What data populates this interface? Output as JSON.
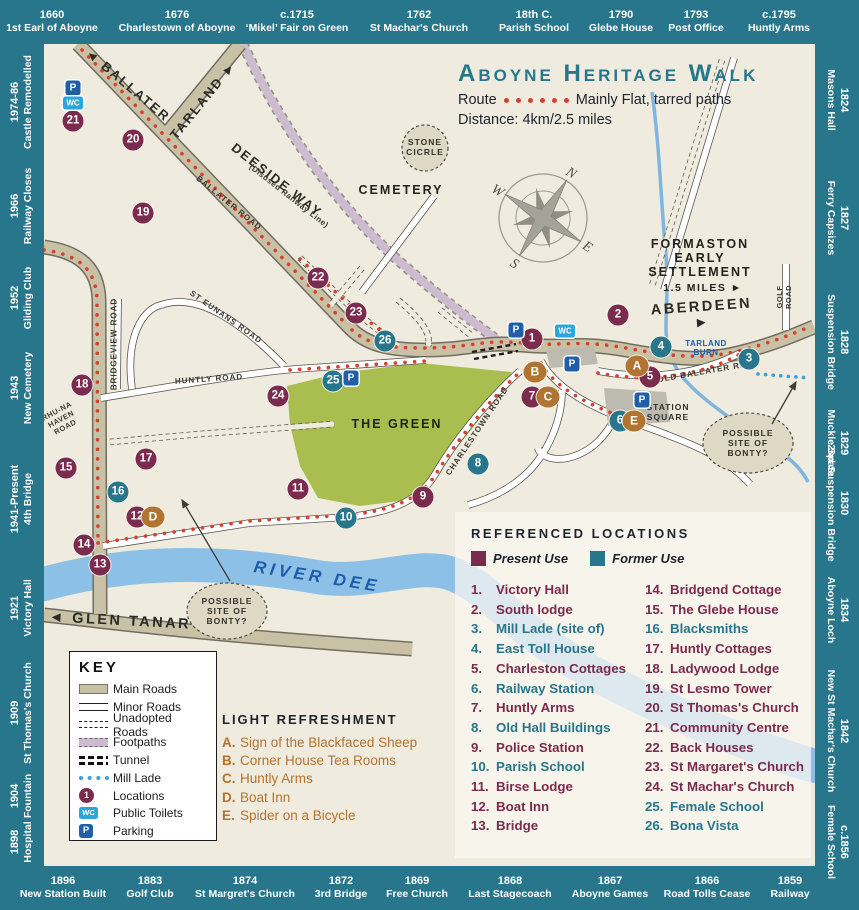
{
  "colors": {
    "border_teal": "#27768B",
    "map_cream": "#EFEBDF",
    "present_use": "#7B2B4E",
    "former_use": "#27768B",
    "refreshment_brown": "#B27431",
    "route_red": "#D6402E",
    "river_blue": "#8CC0E6",
    "parking_blue": "#1E5FA8",
    "wc_blue": "#2BA6DC",
    "green_area": "#A9BE4F",
    "main_road_tan": "#C9C1A6",
    "footpath_mauve": "#CDBBD0"
  },
  "header": {
    "title": "Aboyne Heritage Walk",
    "route_label": "Route",
    "route_desc": "Mainly Flat, tarred paths",
    "route_dots": 6,
    "distance": "Distance: 4km/2.5 miles"
  },
  "timeline": {
    "top": [
      {
        "year": "1660",
        "label": "1st Earl of Aboyne",
        "cx": 52
      },
      {
        "year": "1676",
        "label": "Charlestown of Aboyne",
        "cx": 177
      },
      {
        "year": "c.1715",
        "label": "‘Mikel’ Fair on Green",
        "cx": 297
      },
      {
        "year": "1762",
        "label": "St Machar's Church",
        "cx": 419
      },
      {
        "year": "18th C.",
        "label": "Parish School",
        "cx": 534
      },
      {
        "year": "1790",
        "label": "Glebe House",
        "cx": 621
      },
      {
        "year": "1793",
        "label": "Post Office",
        "cx": 696
      },
      {
        "year": "c.1795",
        "label": "Huntly Arms",
        "cx": 779
      }
    ],
    "bottom": [
      {
        "year": "1896",
        "label": "New Station Built",
        "cx": 63
      },
      {
        "year": "1883",
        "label": "Golf Club",
        "cx": 150
      },
      {
        "year": "1874",
        "label": "St Margret's Church",
        "cx": 245
      },
      {
        "year": "1872",
        "label": "3rd Bridge",
        "cx": 341
      },
      {
        "year": "1869",
        "label": "Free Church",
        "cx": 417
      },
      {
        "year": "1868",
        "label": "Last Stagecoach",
        "cx": 510
      },
      {
        "year": "1867",
        "label": "Aboyne Games",
        "cx": 610
      },
      {
        "year": "1866",
        "label": "Road Tolls Cease",
        "cx": 707
      },
      {
        "year": "1859",
        "label": "Railway",
        "cx": 790
      }
    ],
    "left": [
      {
        "year": "1974-86",
        "label": "Castle Remodelled",
        "cy": 102
      },
      {
        "year": "1966",
        "label": "Railway Closes",
        "cy": 206
      },
      {
        "year": "1952",
        "label": "Gliding Club",
        "cy": 298
      },
      {
        "year": "1943",
        "label": "New Cemetery",
        "cy": 388
      },
      {
        "year": "1941-Present",
        "label": "4th Bridge",
        "cy": 499
      },
      {
        "year": "1921",
        "label": "Victory Hall",
        "cy": 608
      },
      {
        "year": "1909",
        "label": "St Thomas's Church",
        "cy": 713
      },
      {
        "year": "1904",
        "label": "Fountain",
        "cy": 796
      },
      {
        "year": "1898",
        "label": "Hospital",
        "cy": 842
      }
    ],
    "right": [
      {
        "year": "1824",
        "label": "Masons Hall",
        "cy": 100
      },
      {
        "year": "1827",
        "label": "Ferry Capsizes",
        "cy": 218
      },
      {
        "year": "1828",
        "label": "Suspension Bridge",
        "cy": 342
      },
      {
        "year": "1829",
        "label": "Muckle Spate",
        "cy": 443
      },
      {
        "year": "1830",
        "label": "2nd Suspension Bridge",
        "cy": 503
      },
      {
        "year": "1834",
        "label": "Aboyne Loch",
        "cy": 610
      },
      {
        "year": "1842",
        "label": "New St Machar's Church",
        "cy": 731
      },
      {
        "year": "c.1856",
        "label": "Female School",
        "cy": 842
      }
    ]
  },
  "key": {
    "title": "KEY",
    "items": [
      {
        "label": "Main Roads",
        "swatch": "main"
      },
      {
        "label": "Minor Roads",
        "swatch": "minor"
      },
      {
        "label": "Unadopted Roads",
        "swatch": "unadopted"
      },
      {
        "label": "Footpaths",
        "swatch": "footpath"
      },
      {
        "label": "Tunnel",
        "swatch": "tunnel"
      },
      {
        "label": "Mill Lade",
        "swatch": "lade"
      },
      {
        "label": "Locations",
        "swatch": "locations",
        "icon_text": "1"
      },
      {
        "label": "Public Toilets",
        "swatch": "wc",
        "icon_text": "WC"
      },
      {
        "label": "Parking",
        "swatch": "parking",
        "icon_text": "P"
      }
    ]
  },
  "refreshment": {
    "title": "LIGHT REFRESHMENT",
    "items": [
      {
        "letter": "A.",
        "name": "Sign of the Blackfaced Sheep"
      },
      {
        "letter": "B.",
        "name": "Corner House Tea Rooms"
      },
      {
        "letter": "C.",
        "name": "Huntly Arms"
      },
      {
        "letter": "D.",
        "name": "Boat Inn"
      },
      {
        "letter": "E.",
        "name": "Spider on a Bicycle"
      }
    ]
  },
  "locations": {
    "title": "REFERENCED LOCATIONS",
    "legend": [
      {
        "label": "Present Use",
        "use": "present"
      },
      {
        "label": "Former Use",
        "use": "former"
      }
    ],
    "items": [
      {
        "num": "1.",
        "name": "Victory Hall",
        "use": "present"
      },
      {
        "num": "2.",
        "name": "South lodge",
        "use": "present"
      },
      {
        "num": "3.",
        "name": "Mill Lade (site of)",
        "use": "former"
      },
      {
        "num": "4.",
        "name": "East Toll House",
        "use": "former"
      },
      {
        "num": "5.",
        "name": "Charleston Cottages",
        "use": "present"
      },
      {
        "num": "6.",
        "name": "Railway Station",
        "use": "former"
      },
      {
        "num": "7.",
        "name": "Huntly Arms",
        "use": "present"
      },
      {
        "num": "8.",
        "name": "Old Hall Buildings",
        "use": "former"
      },
      {
        "num": "9.",
        "name": "Police Station",
        "use": "present"
      },
      {
        "num": "10.",
        "name": "Parish School",
        "use": "former"
      },
      {
        "num": "11.",
        "name": "Birse Lodge",
        "use": "present"
      },
      {
        "num": "12.",
        "name": "Boat Inn",
        "use": "present"
      },
      {
        "num": "13.",
        "name": "Bridge",
        "use": "present"
      },
      {
        "num": "14.",
        "name": "Bridgend Cottage",
        "use": "present"
      },
      {
        "num": "15.",
        "name": "The Glebe House",
        "use": "present"
      },
      {
        "num": "16.",
        "name": "Blacksmiths",
        "use": "former"
      },
      {
        "num": "17.",
        "name": "Huntly Cottages",
        "use": "present"
      },
      {
        "num": "18.",
        "name": "Ladywood Lodge",
        "use": "present"
      },
      {
        "num": "19.",
        "name": "St Lesmo Tower",
        "use": "present"
      },
      {
        "num": "20.",
        "name": "St Thomas's Church",
        "use": "present"
      },
      {
        "num": "21.",
        "name": "Community Centre",
        "use": "present"
      },
      {
        "num": "22.",
        "name": "Back Houses",
        "use": "present"
      },
      {
        "num": "23.",
        "name": "St Margaret's Church",
        "use": "present"
      },
      {
        "num": "24.",
        "name": "St Machar's Church",
        "use": "present"
      },
      {
        "num": "25.",
        "name": "Female School",
        "use": "former"
      },
      {
        "num": "26.",
        "name": "Bona Vista",
        "use": "former"
      }
    ]
  },
  "markers": {
    "parking_label": "P",
    "wc_label": "WC",
    "numbered": [
      {
        "n": "1",
        "x": 532,
        "y": 339,
        "use": "present"
      },
      {
        "n": "2",
        "x": 618,
        "y": 315,
        "use": "present"
      },
      {
        "n": "3",
        "x": 749,
        "y": 359,
        "use": "former"
      },
      {
        "n": "4",
        "x": 661,
        "y": 347,
        "use": "former"
      },
      {
        "n": "5",
        "x": 650,
        "y": 377,
        "use": "present"
      },
      {
        "n": "6",
        "x": 620,
        "y": 421,
        "use": "former"
      },
      {
        "n": "7",
        "x": 532,
        "y": 397,
        "use": "present"
      },
      {
        "n": "8",
        "x": 478,
        "y": 464,
        "use": "former"
      },
      {
        "n": "9",
        "x": 423,
        "y": 497,
        "use": "present"
      },
      {
        "n": "10",
        "x": 346,
        "y": 518,
        "use": "former"
      },
      {
        "n": "11",
        "x": 298,
        "y": 489,
        "use": "present"
      },
      {
        "n": "12",
        "x": 137,
        "y": 517,
        "use": "present"
      },
      {
        "n": "13",
        "x": 100,
        "y": 565,
        "use": "present"
      },
      {
        "n": "14",
        "x": 84,
        "y": 545,
        "use": "present"
      },
      {
        "n": "15",
        "x": 66,
        "y": 468,
        "use": "present"
      },
      {
        "n": "16",
        "x": 118,
        "y": 492,
        "use": "former"
      },
      {
        "n": "17",
        "x": 146,
        "y": 459,
        "use": "present"
      },
      {
        "n": "18",
        "x": 82,
        "y": 385,
        "use": "present"
      },
      {
        "n": "19",
        "x": 143,
        "y": 213,
        "use": "present"
      },
      {
        "n": "20",
        "x": 133,
        "y": 140,
        "use": "present"
      },
      {
        "n": "21",
        "x": 73,
        "y": 121,
        "use": "present"
      },
      {
        "n": "22",
        "x": 318,
        "y": 278,
        "use": "present"
      },
      {
        "n": "23",
        "x": 356,
        "y": 313,
        "use": "present"
      },
      {
        "n": "24",
        "x": 278,
        "y": 396,
        "use": "present"
      },
      {
        "n": "25",
        "x": 333,
        "y": 381,
        "use": "former"
      },
      {
        "n": "26",
        "x": 385,
        "y": 341,
        "use": "former"
      }
    ],
    "letters": [
      {
        "l": "A",
        "x": 637,
        "y": 366
      },
      {
        "l": "B",
        "x": 535,
        "y": 372
      },
      {
        "l": "C",
        "x": 548,
        "y": 397
      },
      {
        "l": "D",
        "x": 153,
        "y": 517
      },
      {
        "l": "E",
        "x": 634,
        "y": 421
      }
    ],
    "parking": [
      {
        "x": 73,
        "y": 88
      },
      {
        "x": 516,
        "y": 330
      },
      {
        "x": 572,
        "y": 364
      },
      {
        "x": 642,
        "y": 400
      },
      {
        "x": 351,
        "y": 378
      }
    ],
    "wc": [
      {
        "x": 73,
        "y": 103
      },
      {
        "x": 565,
        "y": 331
      }
    ]
  },
  "map_labels": [
    {
      "text": "◄ BALLATER",
      "x": 128,
      "y": 85,
      "rot": 40,
      "cls": "rl-big"
    },
    {
      "text": "TARLAND ►",
      "x": 203,
      "y": 100,
      "rot": -51,
      "cls": "rl-big"
    },
    {
      "text": "DEESIDE WAY",
      "x": 277,
      "y": 180,
      "rot": 38,
      "cls": "rl-big"
    },
    {
      "text": "(Disused Railway Line)",
      "x": 289,
      "y": 196,
      "rot": 38,
      "cls": "rl-xs"
    },
    {
      "text": "BALLATER ROAD",
      "x": 229,
      "y": 203,
      "rot": 39,
      "cls": "rl-sm"
    },
    {
      "text": "ST EUNANS ROAD",
      "x": 226,
      "y": 317,
      "rot": 35,
      "cls": "rl-sm"
    },
    {
      "text": "HUNTLY ROAD",
      "x": 209,
      "y": 379,
      "rot": -4,
      "cls": "rl-sm"
    },
    {
      "text": "BRIDGEVIEW ROAD",
      "x": 114,
      "y": 344,
      "rot": -90,
      "cls": "rl-sm"
    },
    {
      "text": "RHU-NA\nHAVEN\nROAD",
      "x": 61,
      "y": 419,
      "rot": -28,
      "cls": "rl-xxs"
    },
    {
      "text": "OLD BALLATER RD",
      "x": 702,
      "y": 372,
      "rot": -10,
      "cls": "rl-sm"
    },
    {
      "text": "CHARLESTOWN ROAD",
      "x": 477,
      "y": 431,
      "rot": -56,
      "cls": "rl-sm"
    },
    {
      "text": "GOLF ROAD",
      "x": 784,
      "y": 297,
      "rot": -90,
      "cls": "rl-xxs"
    },
    {
      "text": "STATION\nSQUARE",
      "x": 668,
      "y": 412,
      "rot": 0,
      "cls": "rl-xsb"
    },
    {
      "text": "CEMETERY",
      "x": 401,
      "y": 190,
      "rot": 0,
      "cls": "rl-place"
    },
    {
      "text": "ABERDEEN ►",
      "x": 702,
      "y": 315,
      "rot": -4,
      "cls": "rl-big2"
    },
    {
      "text": "◄ GLEN TANAR",
      "x": 120,
      "y": 621,
      "rot": 3,
      "cls": "rl-big2"
    },
    {
      "text": "THE GREEN",
      "x": 397,
      "y": 424,
      "rot": 0,
      "cls": "rl-place"
    },
    {
      "text": "RIVER DEE",
      "x": 317,
      "y": 577,
      "rot": 9,
      "cls": "rl-river"
    },
    {
      "text": "TARLAND\nBURN",
      "x": 706,
      "y": 348,
      "rot": 0,
      "cls": "rl-blue"
    },
    {
      "text": "FORMASTON\nEARLY\nSETTLEMENT",
      "x": 700,
      "y": 258,
      "rot": 0,
      "cls": "rl-place"
    },
    {
      "text": "1.5 MILES ►",
      "x": 703,
      "y": 288,
      "rot": 0,
      "cls": "rl-miles"
    },
    {
      "text": "STONE\nCICRLE",
      "x": 425,
      "y": 147,
      "rot": 0,
      "cls": "rl-xsb"
    },
    {
      "text": "POSSIBLE\nSITE OF\nBONTY?",
      "x": 227,
      "y": 611,
      "rot": 0,
      "cls": "rl-xsb"
    },
    {
      "text": "POSSIBLE\nSITE OF\nBONTY?",
      "x": 748,
      "y": 443,
      "rot": 0,
      "cls": "rl-xsb"
    }
  ],
  "compass": {
    "n": "N",
    "e": "E",
    "s": "S",
    "w": "W"
  }
}
